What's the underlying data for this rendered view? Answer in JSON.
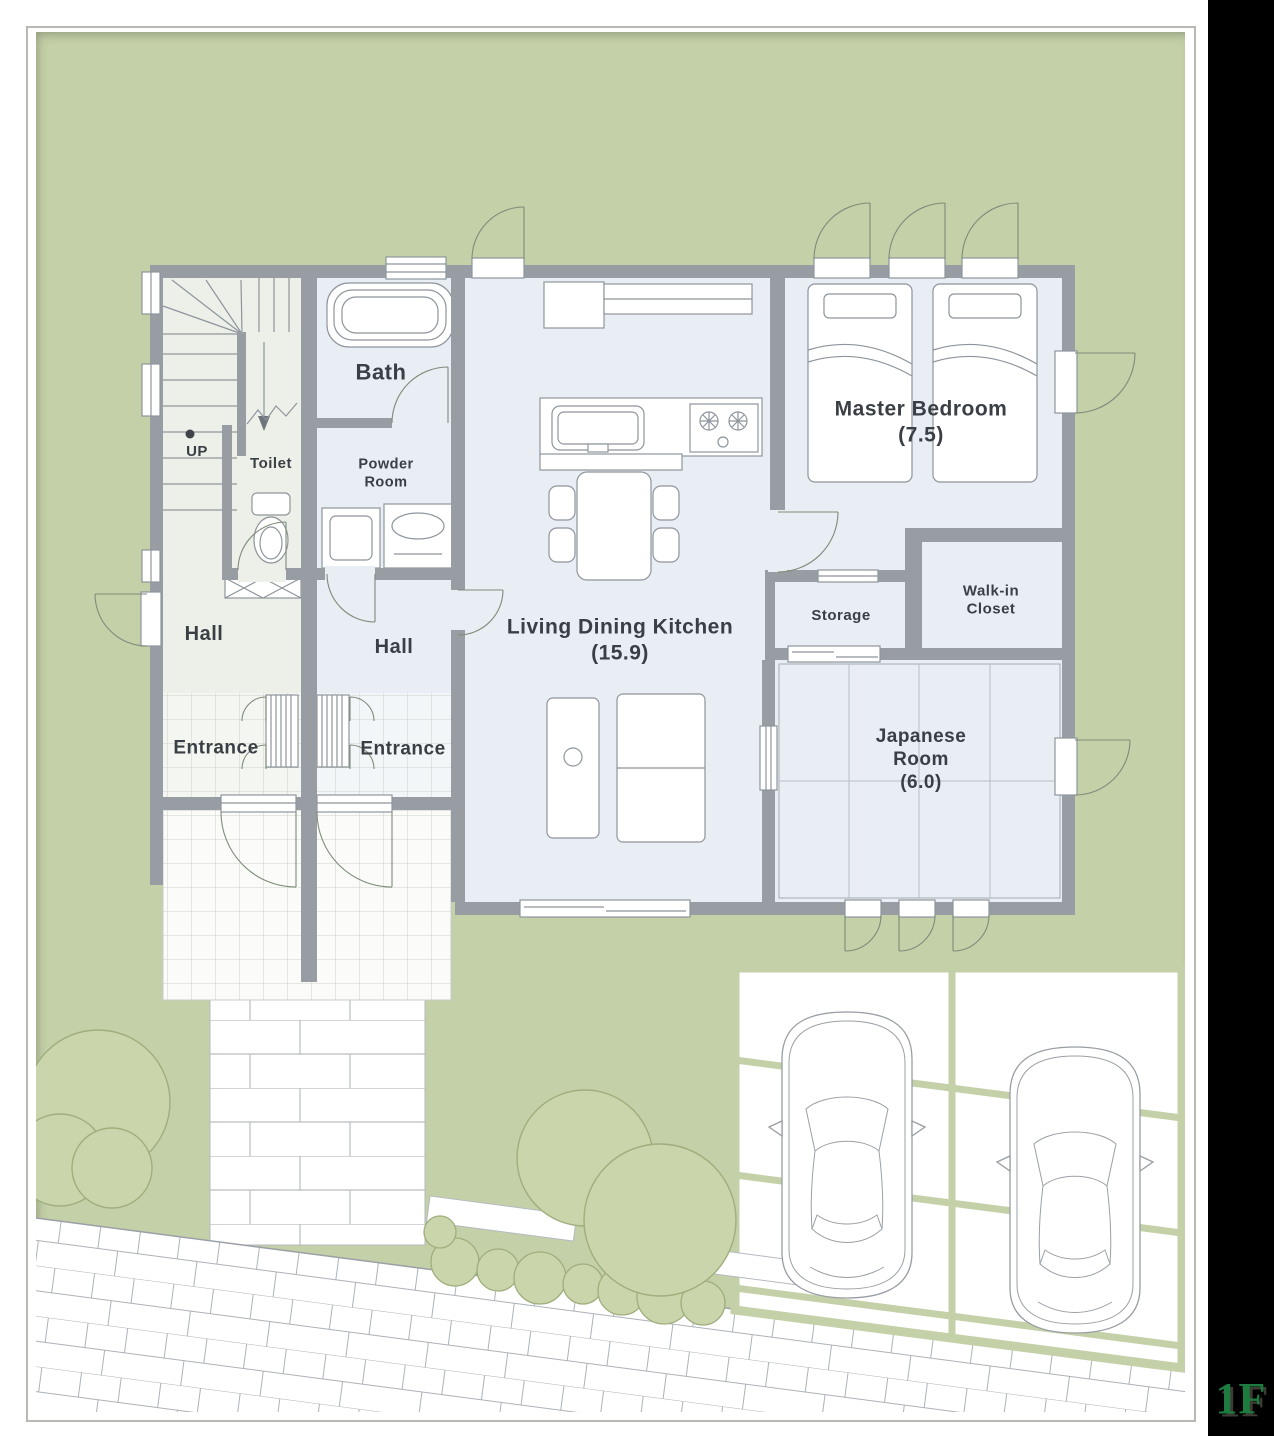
{
  "plan": {
    "floor_badge": "1F",
    "stairs_direction": "UP",
    "rooms": {
      "bath": {
        "label": "Bath"
      },
      "toilet": {
        "label": "Toilet"
      },
      "powder_room": {
        "label": "Powder Room"
      },
      "hall_left": {
        "label": "Hall"
      },
      "hall_right": {
        "label": "Hall"
      },
      "entrance_left": {
        "label": "Entrance"
      },
      "entrance_right": {
        "label": "Entrance"
      },
      "ldk": {
        "label": "Living Dining Kitchen",
        "area": "(15.9)"
      },
      "master_bedroom": {
        "label": "Master Bedroom",
        "area": "(7.5)"
      },
      "storage": {
        "label": "Storage"
      },
      "walk_in_closet": {
        "label": "Walk-in Closet"
      },
      "japanese_room": {
        "label": "Japanese Room",
        "area": "(6.0)"
      }
    },
    "colors": {
      "lawn": "#c4d0a8",
      "wall": "#989da4",
      "room_floor": "#e9edf4",
      "left_unit_floor": "#edf0e9",
      "floor_badge_green": "#1e7b40",
      "outside_strip": "#000000"
    }
  }
}
